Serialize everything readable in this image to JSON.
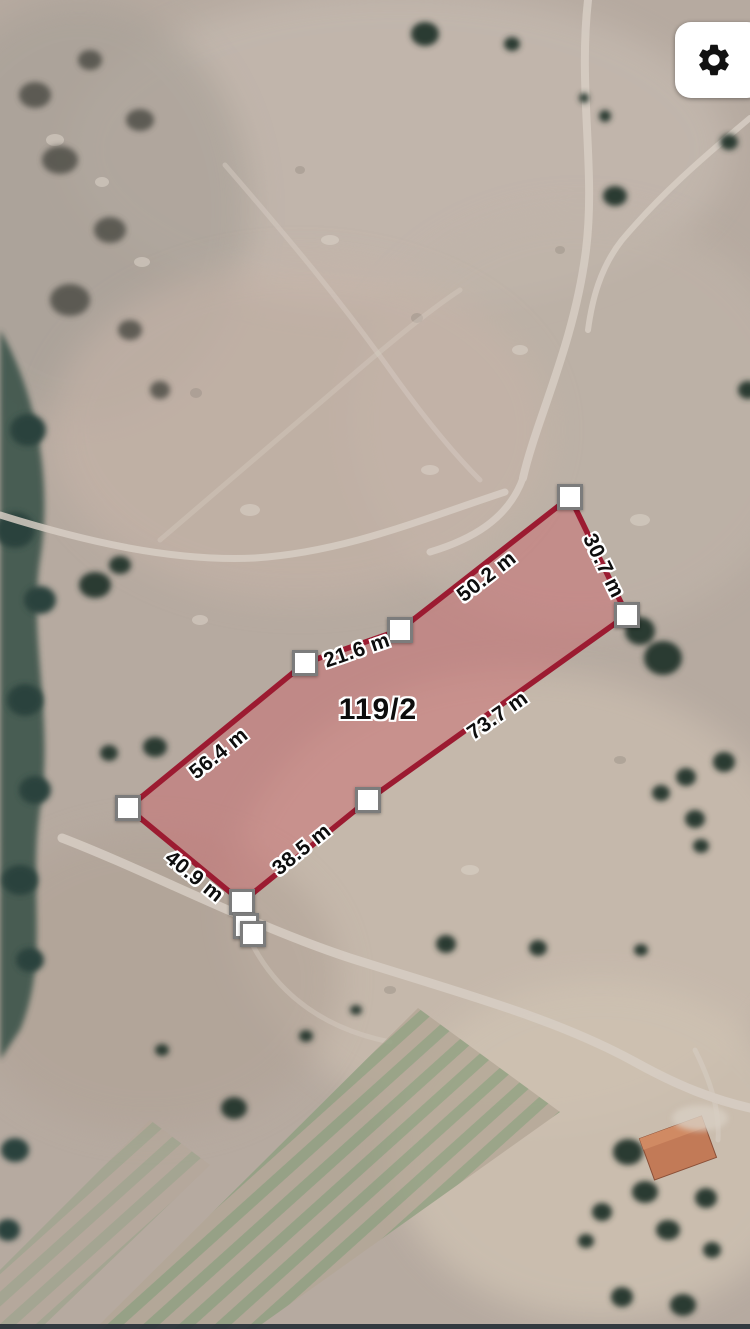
{
  "map": {
    "view": "satellite",
    "parcel": {
      "id": "119/2",
      "measurements": [
        {
          "edge": "west-upper",
          "label": "56.4 m"
        },
        {
          "edge": "west-short",
          "label": "21.6 m"
        },
        {
          "edge": "north",
          "label": "50.2 m"
        },
        {
          "edge": "east",
          "label": "30.7 m"
        },
        {
          "edge": "south-long",
          "label": "73.7 m"
        },
        {
          "edge": "south-short",
          "label": "38.5 m"
        },
        {
          "edge": "southwest",
          "label": "40.9 m"
        }
      ]
    },
    "colors": {
      "parcel_outline": "#9C1B31",
      "parcel_fill": "#CC6168",
      "marker_fill": "#FFFFFF",
      "marker_border": "#7C7C7C"
    }
  },
  "toolbar": {
    "icons": {
      "settings": "gear"
    }
  }
}
